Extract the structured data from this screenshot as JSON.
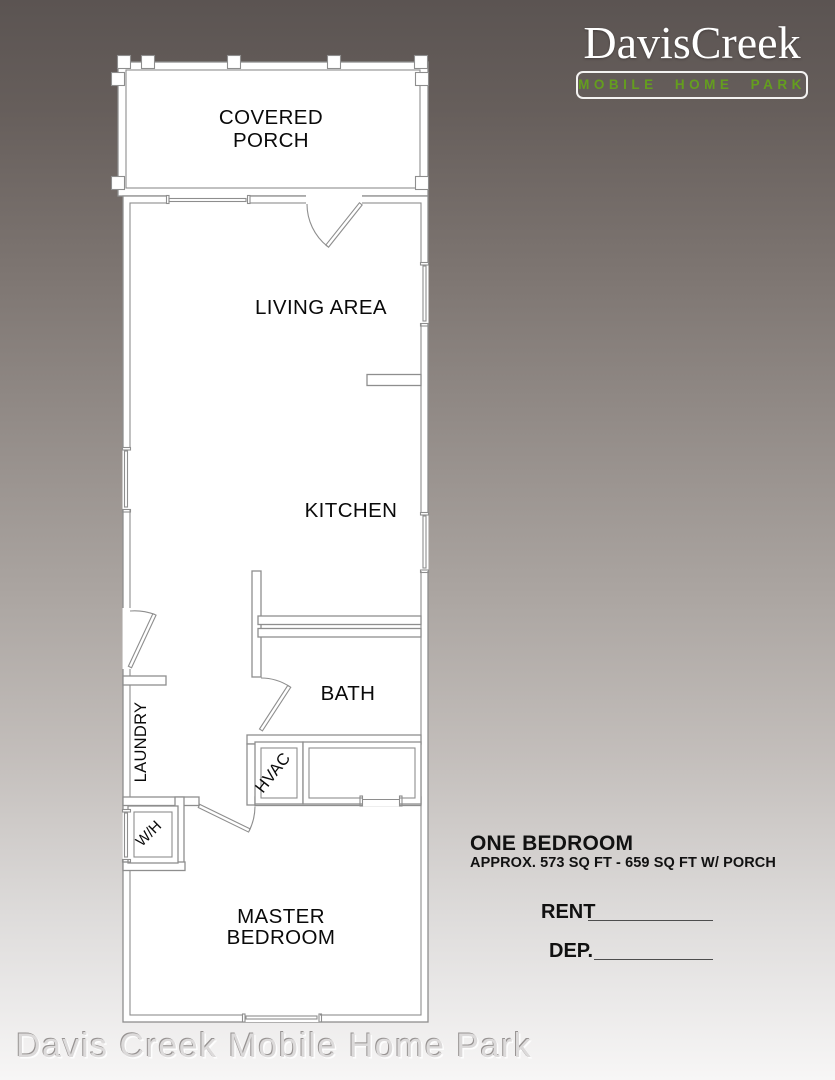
{
  "logo": {
    "name": "DavisCreek",
    "tagline": "MOBILE HOME PARK"
  },
  "plan": {
    "covered_porch_line1": "COVERED",
    "covered_porch_line2": "PORCH",
    "living_area": "LIVING AREA",
    "kitchen": "KITCHEN",
    "bath": "BATH",
    "laundry": "LAUNDRY",
    "hvac": "HVAC",
    "water_heater": "W/H",
    "master_bedroom_line1": "MASTER",
    "master_bedroom_line2": "BEDROOM"
  },
  "unit_info": {
    "title": "ONE BEDROOM",
    "area": "APPROX. 573 SQ FT - 659 SQ FT W/ PORCH",
    "rent_label": "RENT",
    "rent_value": "",
    "deposit_label": "DEP.",
    "deposit_value": ""
  },
  "watermark": "Davis Creek Mobile Home Park",
  "colors": {
    "logo_text": "#ffffff",
    "tagline_green": "#649e1e",
    "plan_background": "#ffffff",
    "plan_line": "#8e8e8e",
    "label_text": "#000000"
  }
}
